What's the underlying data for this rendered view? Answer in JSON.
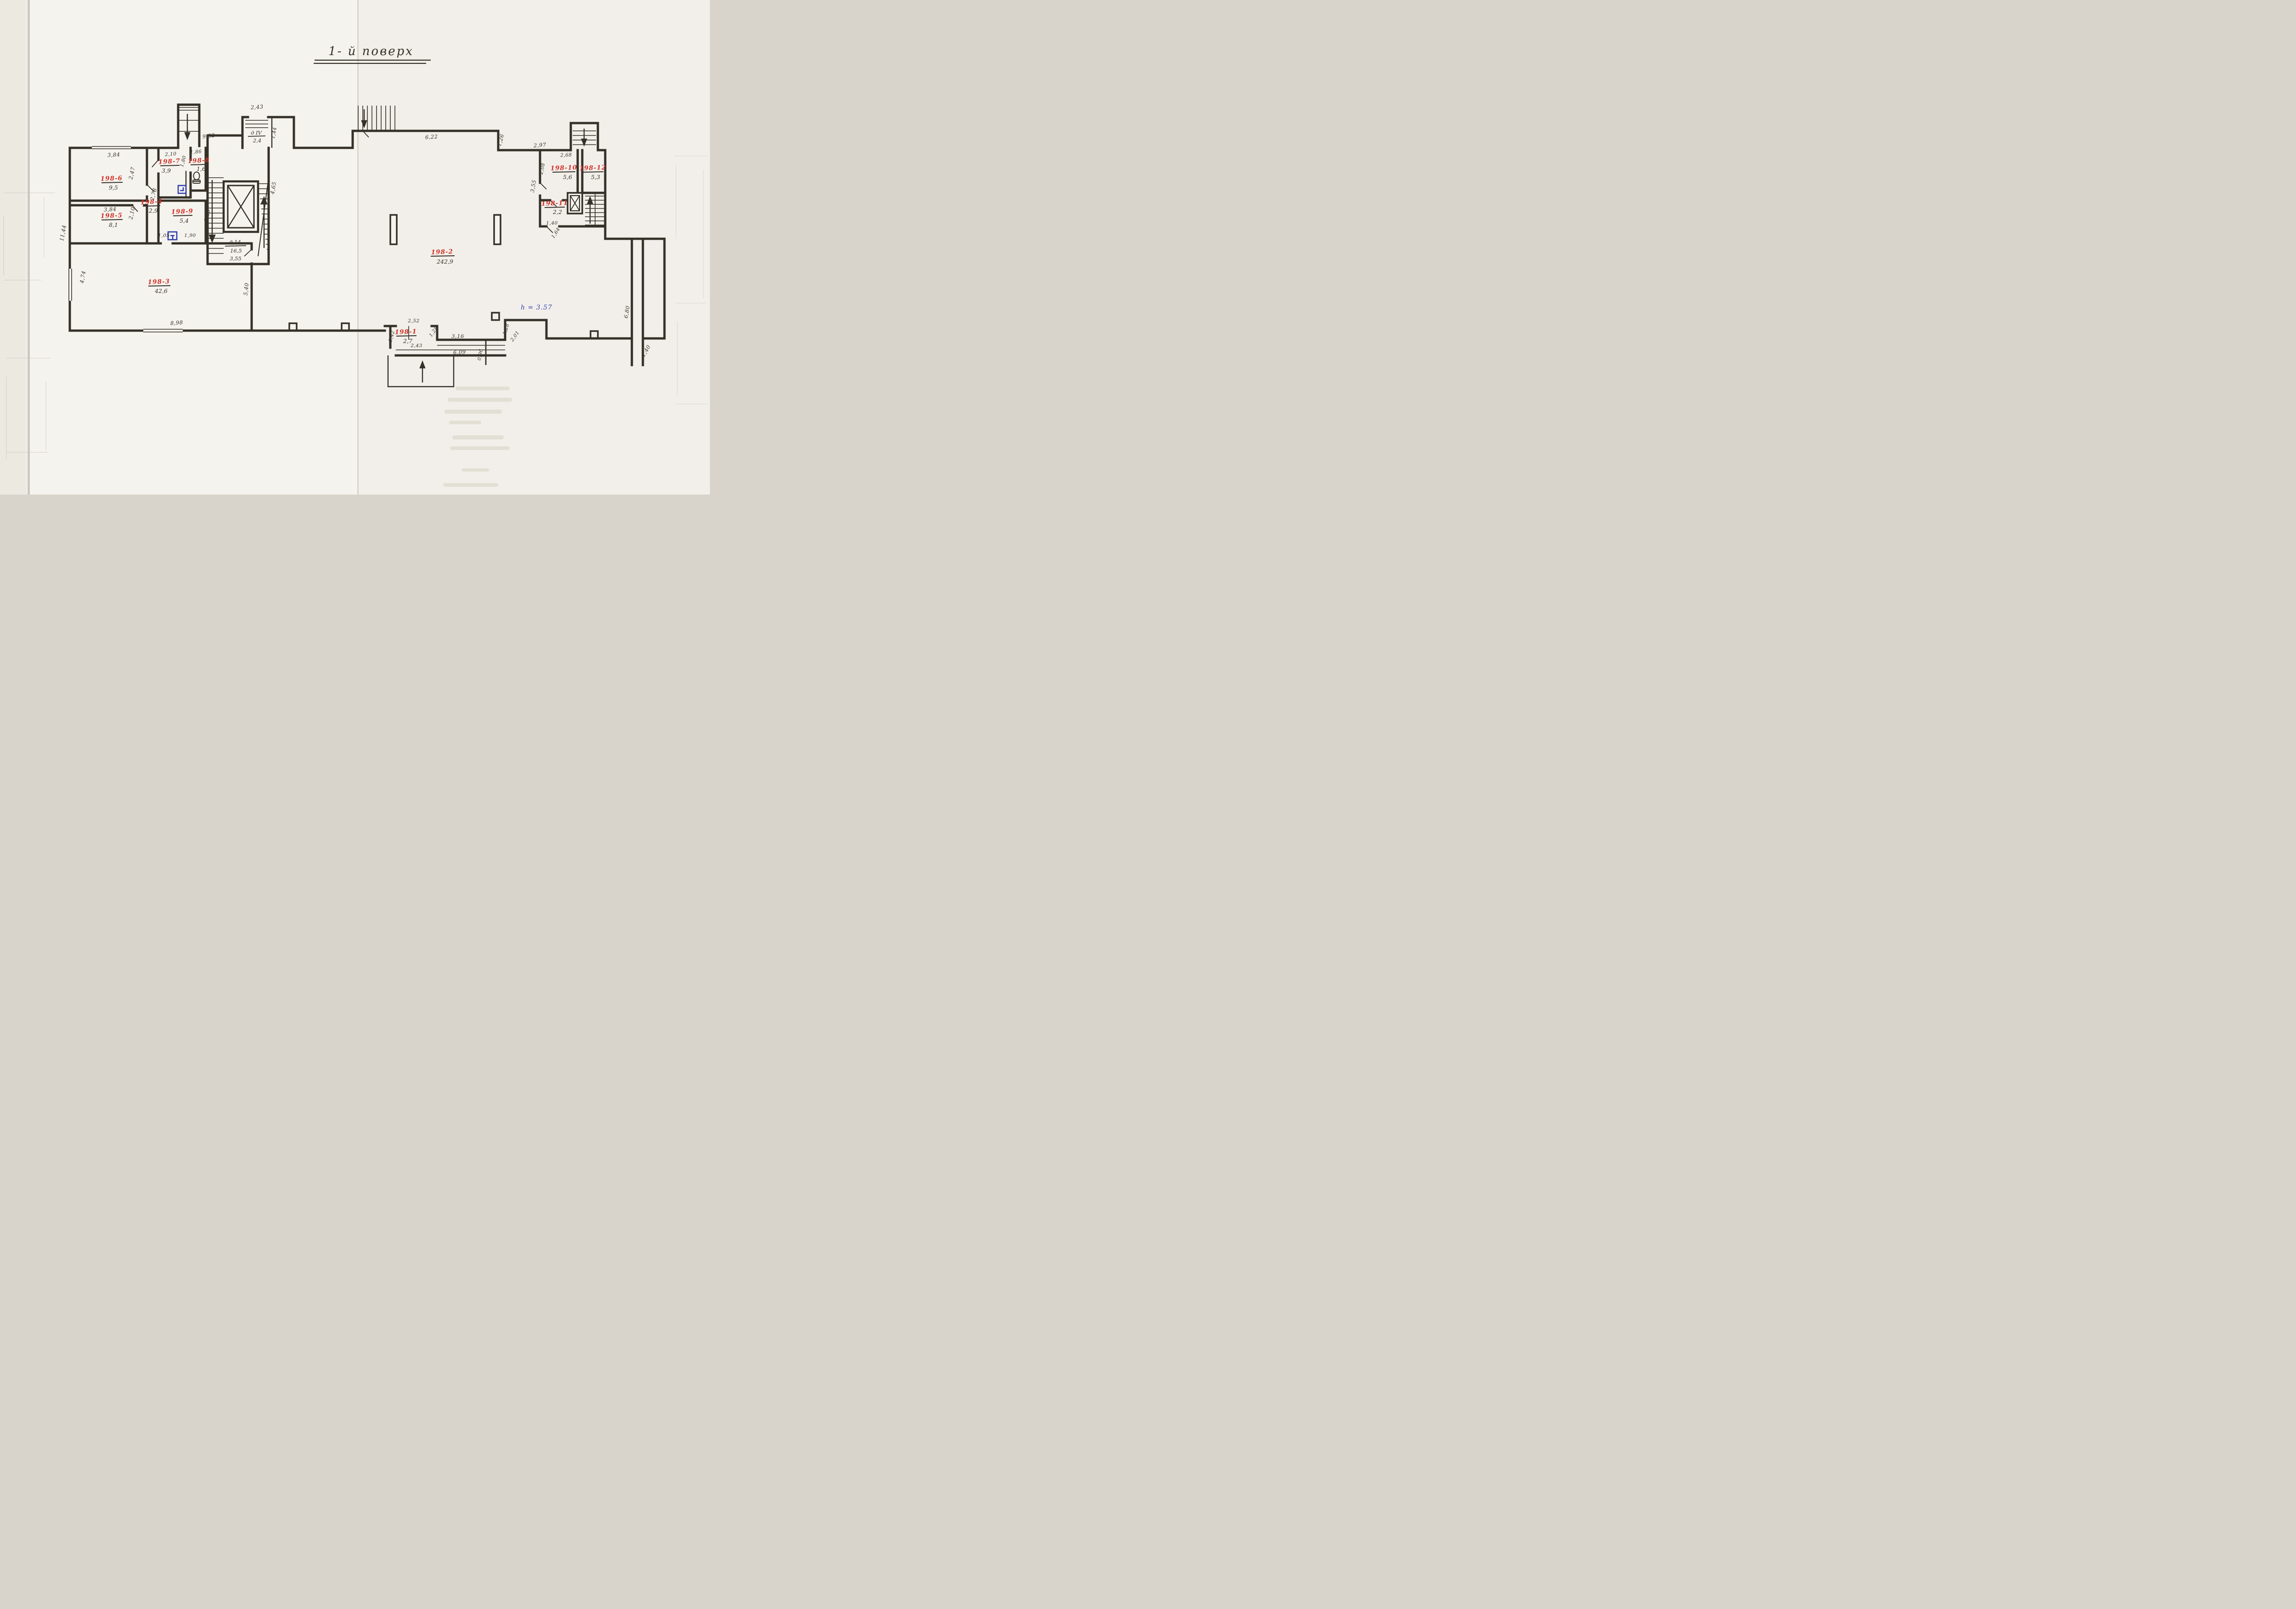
{
  "title": "1- й поверх",
  "note_height": "h = 3.57",
  "colors": {
    "ink": "#353028",
    "red": "#d23227",
    "blue": "#2f3eae",
    "paper": "#f5f3ee"
  },
  "rooms": {
    "r1": {
      "id": "198-1",
      "area": "2,7"
    },
    "r2": {
      "id": "198-2",
      "area": "242,9"
    },
    "r3": {
      "id": "198-3",
      "area": "42,6"
    },
    "r4": {
      "id": "198-4",
      "area": "2,9"
    },
    "r5": {
      "id": "198-5",
      "area": "8,1"
    },
    "r6": {
      "id": "198-6",
      "area": "9,5"
    },
    "r7": {
      "id": "198-7",
      "area": "3,9"
    },
    "r8": {
      "id": "198-8",
      "area": "1,6"
    },
    "r9": {
      "id": "198-9",
      "area": "5,4"
    },
    "r10": {
      "id": "198-10",
      "area": "5,6"
    },
    "r11": {
      "id": "198-11",
      "area": "2,2"
    },
    "r12": {
      "id": "198-12",
      "area": "5,3"
    }
  },
  "stairwell": {
    "vestibule_id": "д IV",
    "vestibule_area": "2,4",
    "stair_id": "д 14",
    "stair_area": "16,5",
    "stair_width": "3,55"
  },
  "dims": {
    "room6_top": "3,84",
    "room6_right": "2,47",
    "room5_top": "3,84",
    "room5_right": "2,10",
    "room7_top": "2,10",
    "room7_niche": "1,80",
    "room8_top": "1,86",
    "corridor_mid": "2,78",
    "room9_right": "1,85",
    "room9_door_left": "1,05",
    "room9_door_right": "1,90",
    "outer_left": "11,44",
    "room3_left": "4,74",
    "room3_bottom": "8,98",
    "room3_right": "5,40",
    "tall_room": "9,82",
    "vestibule_door": "2,43",
    "vestibule_right": "1,44",
    "hall_left": "4,65",
    "hall_top": "6,22",
    "hall_top_step": "1,26",
    "hall_top_right": "2,97",
    "room10_top": "2,68",
    "room10_left": "2,08",
    "wing_left": "3,55",
    "wing_bottom": "1,40",
    "wing_bottom_diag": "1,64",
    "room1_top": "2,52",
    "room1_left": "1,42",
    "room1_bottom": "2,43",
    "room1_diag": "1,28",
    "corridor_top": "3,16",
    "corridor_bottom": "6,09",
    "corridor_step": "1,28",
    "porch_diag": "2,01",
    "porch_right": "0,96",
    "right_room_wall": "6,80",
    "exit_bottom": "1,40"
  }
}
